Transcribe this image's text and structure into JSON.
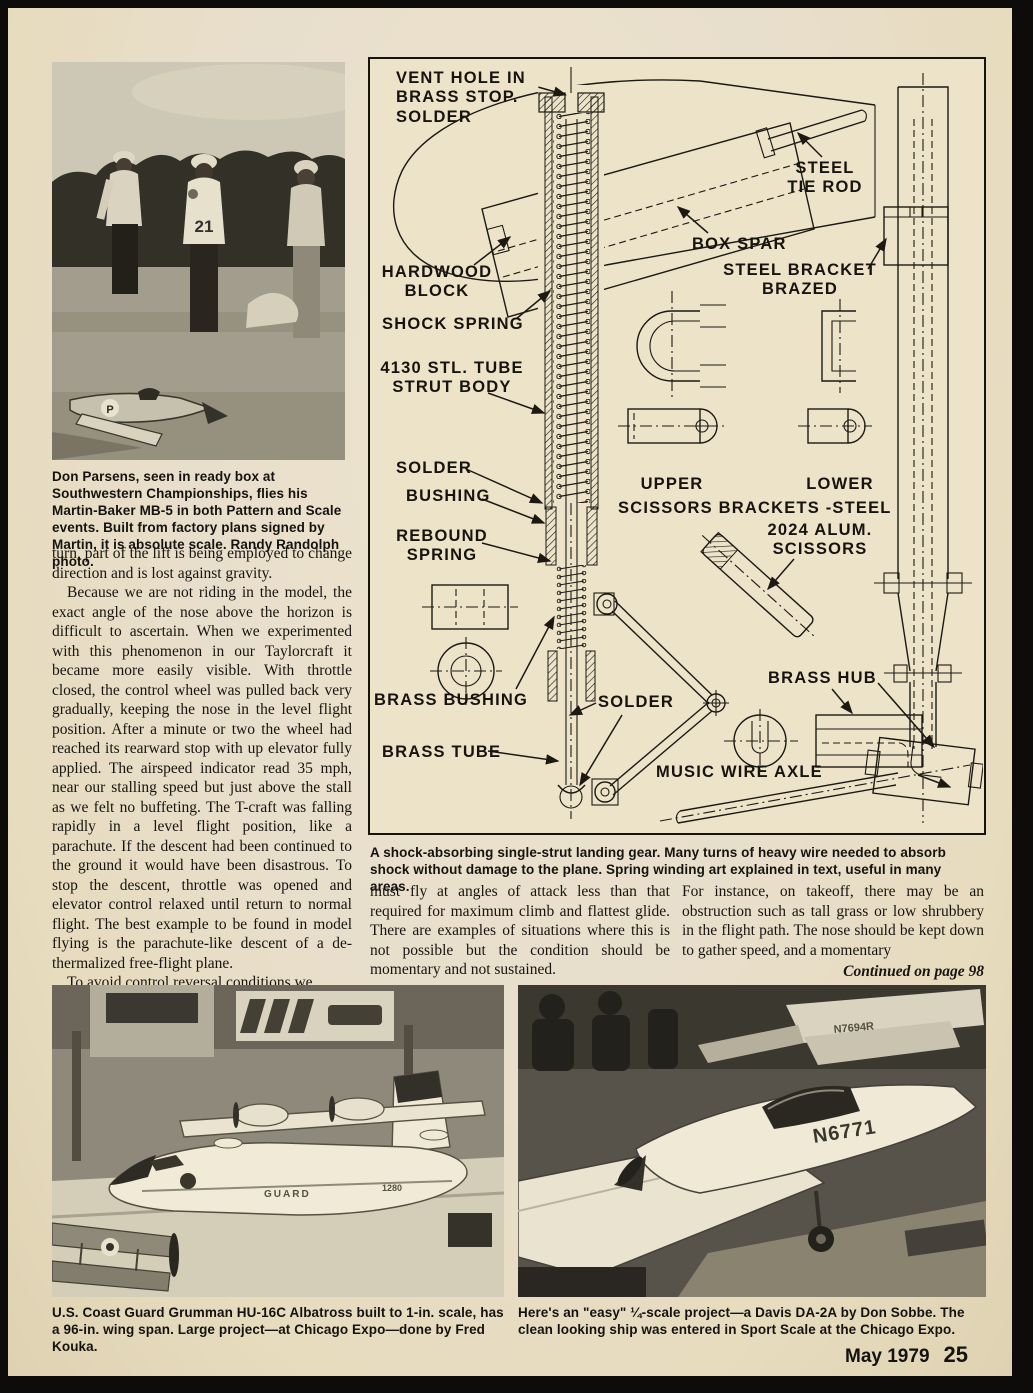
{
  "article": {
    "left_p1": "turn, part of the lift is being employed to change direction and is lost against gravity.",
    "left_p2": "Because we are not riding in the model, the exact angle of the nose above the horizon is difficult to ascertain. When we experimented with this phenomenon in our Taylorcraft it became more easily visible. With throttle closed, the control wheel was pulled back very gradually, keeping the nose in the level flight position. After a minute or two the wheel had reached its rearward stop with up elevator fully applied. The airspeed indicator read 35 mph, near our stalling speed but just above the stall as we felt no buffeting. The T-craft was falling rapidly in a level flight position, like a parachute. If the descent had been continued to the ground it would have been disastrous. To stop the descent, throttle was opened and elevator control relaxed until return to normal flight. The best example to be found in model flying is the parachute-like descent of a de-thermalized free-flight plane.",
    "left_p3": "To avoid control reversal conditions we",
    "mid_p1": "must fly at angles of attack less than that required for maximum climb and flattest glide. There are examples of situations where this is not possible but the condition should be momentary and not sustained.",
    "right_p1": "For instance, on takeoff, there may be an obstruction such as tall grass or low shrubbery in the flight path. The nose should be kept down to gather speed, and a momentary",
    "continued": "Continued on page 98"
  },
  "photos": {
    "top": {
      "caption": "Don Parsens, seen in ready box at Southwestern Championships, flies his Martin-Baker MB-5 in both Pattern and Scale events. Built from factory plans signed by Martin, it is absolute scale. Randy Randolph photo.",
      "shirt_number": "21",
      "wing_letter": "P"
    },
    "bottom_left": {
      "caption": "U.S. Coast Guard Grumman HU-16C Albatross built to 1-in. scale, has a 96-in. wing span. Large project—at Chicago Expo—done by Fred Kouka.",
      "hull_text": "GUARD",
      "hull_number": "1280"
    },
    "bottom_right": {
      "caption": "Here's an \"easy\" ¼-scale project—a Davis DA-2A by Don Sobbe. The clean looking ship was entered in Sport Scale at the Chicago Expo.",
      "tail_number": "N6771",
      "background_tail": "N7694R"
    }
  },
  "diagram": {
    "caption": "A shock-absorbing single-strut landing gear. Many turns of heavy wire needed to absorb shock without damage to the plane. Spring winding art explained in text, useful in many areas.",
    "labels": {
      "vent_hole": "VENT HOLE IN\nBRASS STOP.\nSOLDER",
      "steel_tie_rod": "STEEL\nTIE ROD",
      "box_spar": "BOX SPAR",
      "steel_bracket": "STEEL BRACKET\nBRAZED",
      "hardwood_block": "HARDWOOD\nBLOCK",
      "shock_spring": "SHOCK SPRING",
      "strut_body": "4130 STL. TUBE\nSTRUT BODY",
      "solder_upper": "SOLDER",
      "bushing": "BUSHING",
      "upper": "UPPER",
      "lower": "LOWER",
      "scissors_brackets": "SCISSORS BRACKETS -STEEL",
      "rebound_spring": "REBOUND\nSPRING",
      "alum_scissors": "2024 ALUM.\nSCISSORS",
      "brass_bushing": "BRASS BUSHING",
      "solder_lower": "SOLDER",
      "brass_hub": "BRASS HUB",
      "brass_tube": "BRASS TUBE",
      "music_wire_axle": "MUSIC WIRE AXLE"
    }
  },
  "footer": {
    "issue": "May 1979",
    "page_number": "25"
  }
}
